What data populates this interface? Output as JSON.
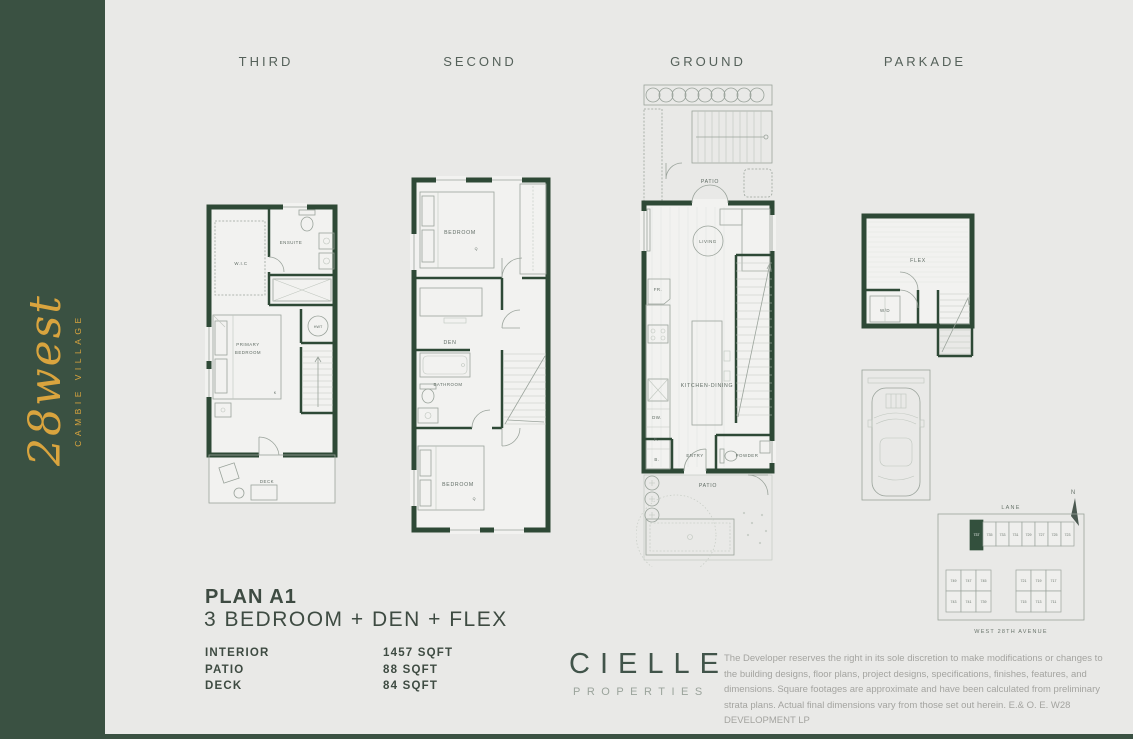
{
  "sidebar": {
    "logo_main": "28west",
    "logo_sub": "CAMBIE VILLAGE"
  },
  "floor_labels": {
    "third": "THIRD",
    "second": "SECOND",
    "ground": "GROUND",
    "parkade": "PARKADE"
  },
  "plan": {
    "title": "PLAN A1",
    "subtitle": "3 BEDROOM + DEN + FLEX",
    "areas": [
      {
        "label": "INTERIOR",
        "value": "1457 SQFT"
      },
      {
        "label": "PATIO",
        "value": "88 SQFT"
      },
      {
        "label": "DECK",
        "value": "84 SQFT"
      }
    ]
  },
  "brand": {
    "name": "CIELLE",
    "tagline": "PROPERTIES"
  },
  "disclaimer": "The Developer reserves the right in its sole discretion to make modifications or changes to the building designs, floor plans, project designs, specifications, finishes, features, and dimensions. Square footages are approximate and have been calculated from preliminary strata plans. Actual final dimensions vary from those set out herein. E.& O. E. W28 DEVELOPMENT LP",
  "rooms": {
    "third": {
      "wic": "W.I.C",
      "ensuite": "ENSUITE",
      "hwt": "HWT",
      "primary_line1": "PRIMARY",
      "primary_line2": "BEDROOM",
      "bed_size": "K",
      "deck": "DECK"
    },
    "second": {
      "bedroom_top": "BEDROOM",
      "bed_top_size": "Q",
      "den": "DEN",
      "bathroom": "BATHROOM",
      "bedroom_bottom": "BEDROOM",
      "bed_bottom_size": "Q"
    },
    "ground": {
      "patio_upper": "PATIO",
      "living": "LIVING",
      "fridge": "FR.",
      "kitchen_dining": "KITCHEN-DINING",
      "dishwasher": "DW.",
      "pantry": "P.",
      "closet": "B.",
      "entry": "ENTRY",
      "powder": "POWDER",
      "patio_lower": "PATIO"
    },
    "parkade": {
      "flex": "FLEX",
      "washer_dryer": "W/D"
    }
  },
  "sitemap": {
    "lane": "LANE",
    "street": "WEST 28TH AVENUE",
    "north": "N",
    "highlighted_unit": "737",
    "top_row": [
      "737",
      "735",
      "733",
      "731",
      "729",
      "727",
      "725",
      "723"
    ],
    "left_block": [
      "749",
      "747",
      "745",
      "743",
      "741",
      "739"
    ],
    "right_block": [
      "721",
      "719",
      "717",
      "715",
      "713",
      "711"
    ]
  },
  "colors": {
    "background": "#E9E9E7",
    "sidebar_green": "#3A5142",
    "wall_green": "#2E4936",
    "gold": "#D9A43E",
    "heading_text": "#3E4B42",
    "muted_text": "#A4A4A0"
  }
}
